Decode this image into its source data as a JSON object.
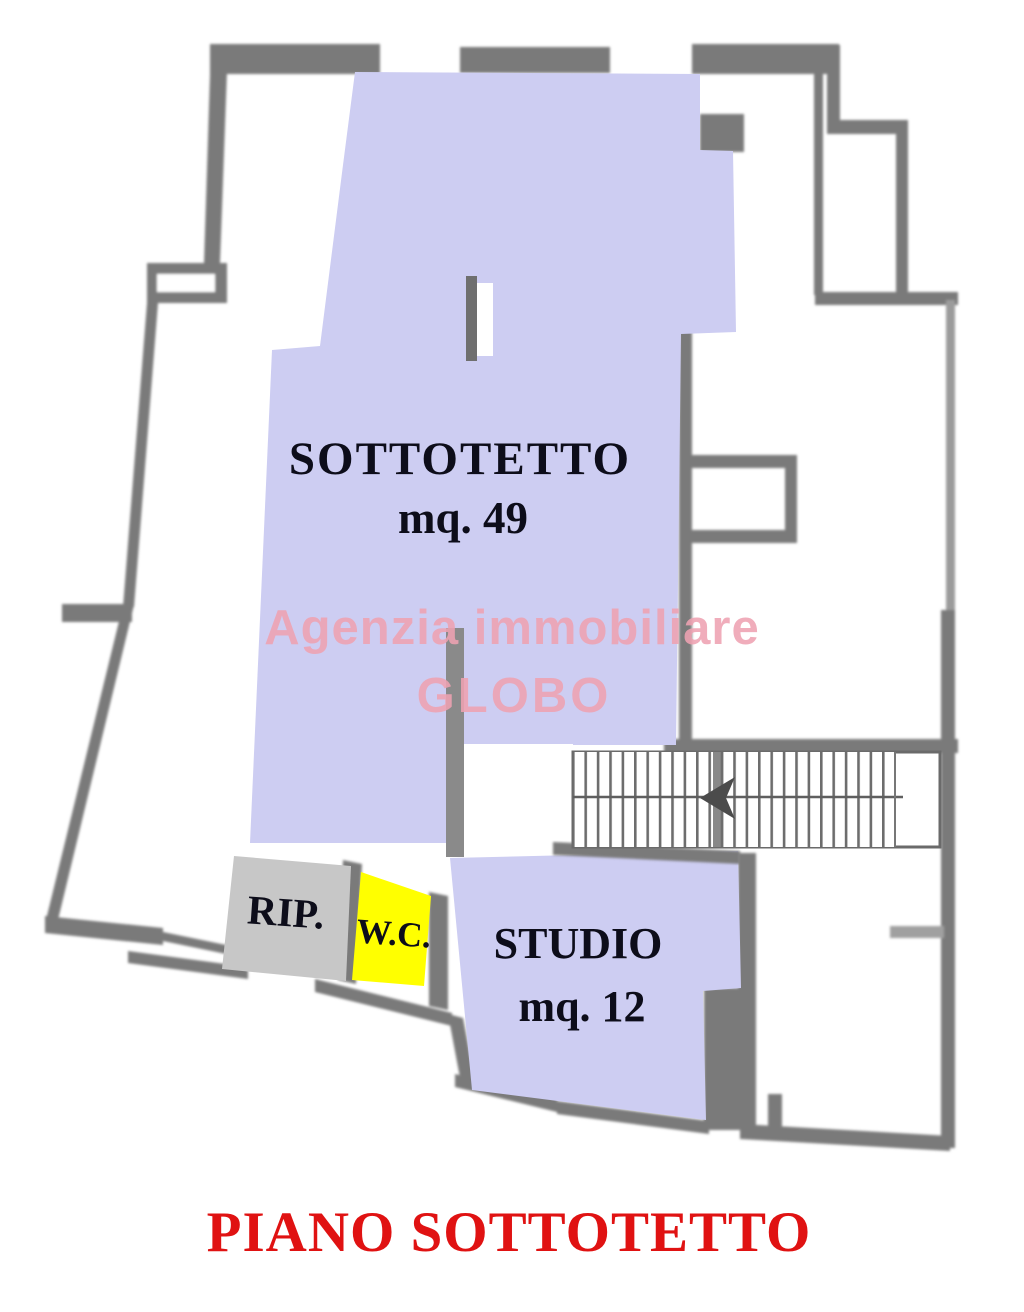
{
  "plan": {
    "title": {
      "text": "PIANO SOTTOTETTO",
      "color": "#e01212"
    },
    "watermark": {
      "line1": "Agenzia immobiliare",
      "line2": "GLOBO",
      "color": "#efa2b2"
    },
    "label_color": "#0d0d1a",
    "wall_color": "#7a7a7a",
    "rooms": [
      {
        "name": "SOTTOTETTO",
        "area": "mq. 49",
        "fill": "#cdcdf2"
      },
      {
        "name": "RIP.",
        "area": "",
        "fill": "#c7c7c7"
      },
      {
        "name": "W.C.",
        "area": "",
        "fill": "#ffff00"
      },
      {
        "name": "STUDIO",
        "area": "mq. 12",
        "fill": "#cdcdf2"
      }
    ],
    "features": [
      {
        "name": "stairs"
      }
    ]
  }
}
